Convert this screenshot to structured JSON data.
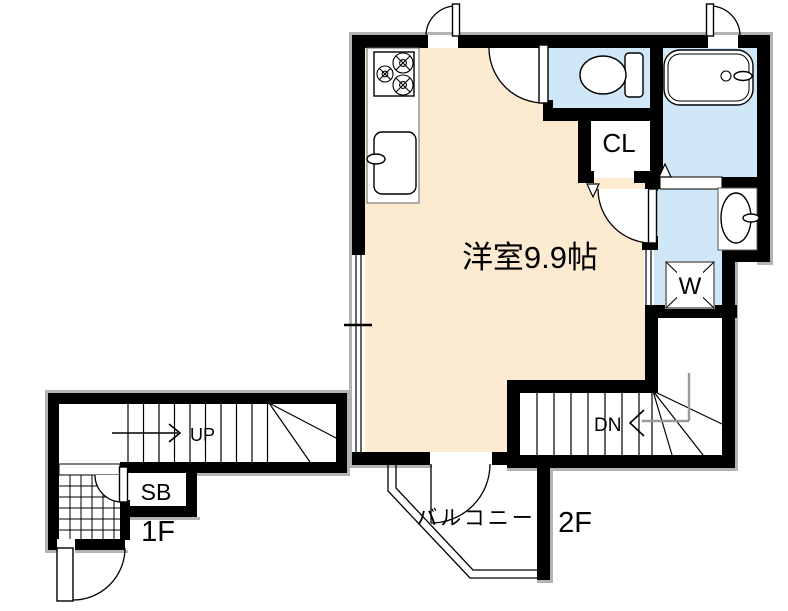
{
  "floor2": {
    "room_label": "洋室9.9帖",
    "closet_label": "CL",
    "washer_label": "W",
    "stairs_label": "DN",
    "balcony_label": "バルコニー",
    "floor_label": "2F"
  },
  "floor1": {
    "stairs_label": "UP",
    "shoebox_label": "SB",
    "floor_label": "1F"
  },
  "colors": {
    "room_fill": "#FCEBD0",
    "wet_area_fill": "#CFE7F6",
    "wall": "#000000",
    "stair_guide_gray": "#999999",
    "shadow": "#b3b3b3"
  }
}
